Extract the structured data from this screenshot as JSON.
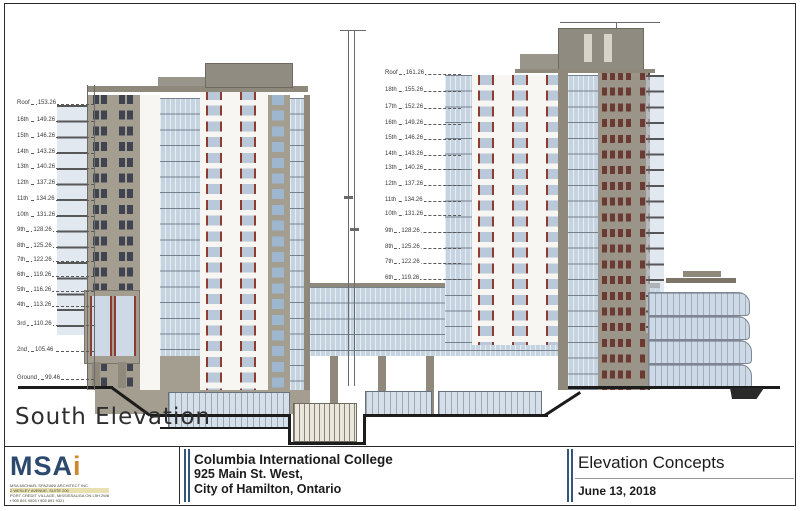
{
  "drawing_title": "South Elevation",
  "levels": {
    "west": [
      {
        "label": "Roof",
        "elev": "153.26",
        "y": 105
      },
      {
        "label": "16th",
        "elev": "149.26",
        "y": 122
      },
      {
        "label": "15th",
        "elev": "146.26",
        "y": 138
      },
      {
        "label": "14th",
        "elev": "143.26",
        "y": 154
      },
      {
        "label": "13th",
        "elev": "140.26",
        "y": 169
      },
      {
        "label": "12th",
        "elev": "137.26",
        "y": 185
      },
      {
        "label": "11th",
        "elev": "134.26",
        "y": 201
      },
      {
        "label": "10th",
        "elev": "131.26",
        "y": 217
      },
      {
        "label": "9th",
        "elev": "128.26",
        "y": 232
      },
      {
        "label": "8th",
        "elev": "125.26",
        "y": 248
      },
      {
        "label": "7th",
        "elev": "122.26",
        "y": 262
      },
      {
        "label": "6th",
        "elev": "119.26",
        "y": 277
      },
      {
        "label": "5th",
        "elev": "116.26",
        "y": 292
      },
      {
        "label": "4th",
        "elev": "113.26",
        "y": 307
      },
      {
        "label": "3rd",
        "elev": "110.26",
        "y": 326
      },
      {
        "label": "2nd",
        "elev": "105.46",
        "y": 352
      },
      {
        "label": "Ground",
        "elev": "99.46",
        "y": 380
      }
    ],
    "east": [
      {
        "label": "Roof",
        "elev": "161.26",
        "y": 75
      },
      {
        "label": "18th",
        "elev": "155.26",
        "y": 92
      },
      {
        "label": "17th",
        "elev": "152.26",
        "y": 109
      },
      {
        "label": "16th",
        "elev": "149.26",
        "y": 125
      },
      {
        "label": "15th",
        "elev": "146.26",
        "y": 140
      },
      {
        "label": "14th",
        "elev": "143.26",
        "y": 156
      },
      {
        "label": "13th",
        "elev": "140.26",
        "y": 170
      },
      {
        "label": "12th",
        "elev": "137.26",
        "y": 186
      },
      {
        "label": "11th",
        "elev": "134.26",
        "y": 202
      },
      {
        "label": "10th",
        "elev": "131.26",
        "y": 216
      },
      {
        "label": "9th",
        "elev": "128.26",
        "y": 233
      },
      {
        "label": "8th",
        "elev": "125.26",
        "y": 249
      },
      {
        "label": "7th",
        "elev": "122.26",
        "y": 264
      },
      {
        "label": "6th",
        "elev": "119.26",
        "y": 280
      }
    ]
  },
  "title_block": {
    "firm": {
      "logo_main": "MSA",
      "logo_accent": "i",
      "address_lines": [
        "MSA MICHAEL SPAZIANI ARCHITECT INC.",
        "2 WESLEY AVENUE, SUITE 200",
        "PORT CREDIT VILLAGE, MISSISSAUGA ON L5H 2W8",
        "t 905 891 9505   f 905 891 9321"
      ]
    },
    "project": {
      "line1": "Columbia International College",
      "line2": "925 Main St. West,",
      "line3": "City of Hamilton, Ontario"
    },
    "sheet": {
      "title": "Elevation Concepts",
      "date": "June 13, 2018"
    }
  },
  "colors": {
    "taupe": "#a49e91",
    "taupe_shadow": "#8f897c",
    "white_facade": "#f7f6f3",
    "glass_blue": "#c6d4e2",
    "accent_red": "#8e3b30",
    "window_dark": "#3f4450",
    "logo_navy": "#2d4a6e",
    "logo_orange": "#d08a2e",
    "title_bar_blue": "#34557c",
    "ground_black": "#1c1c1c"
  }
}
